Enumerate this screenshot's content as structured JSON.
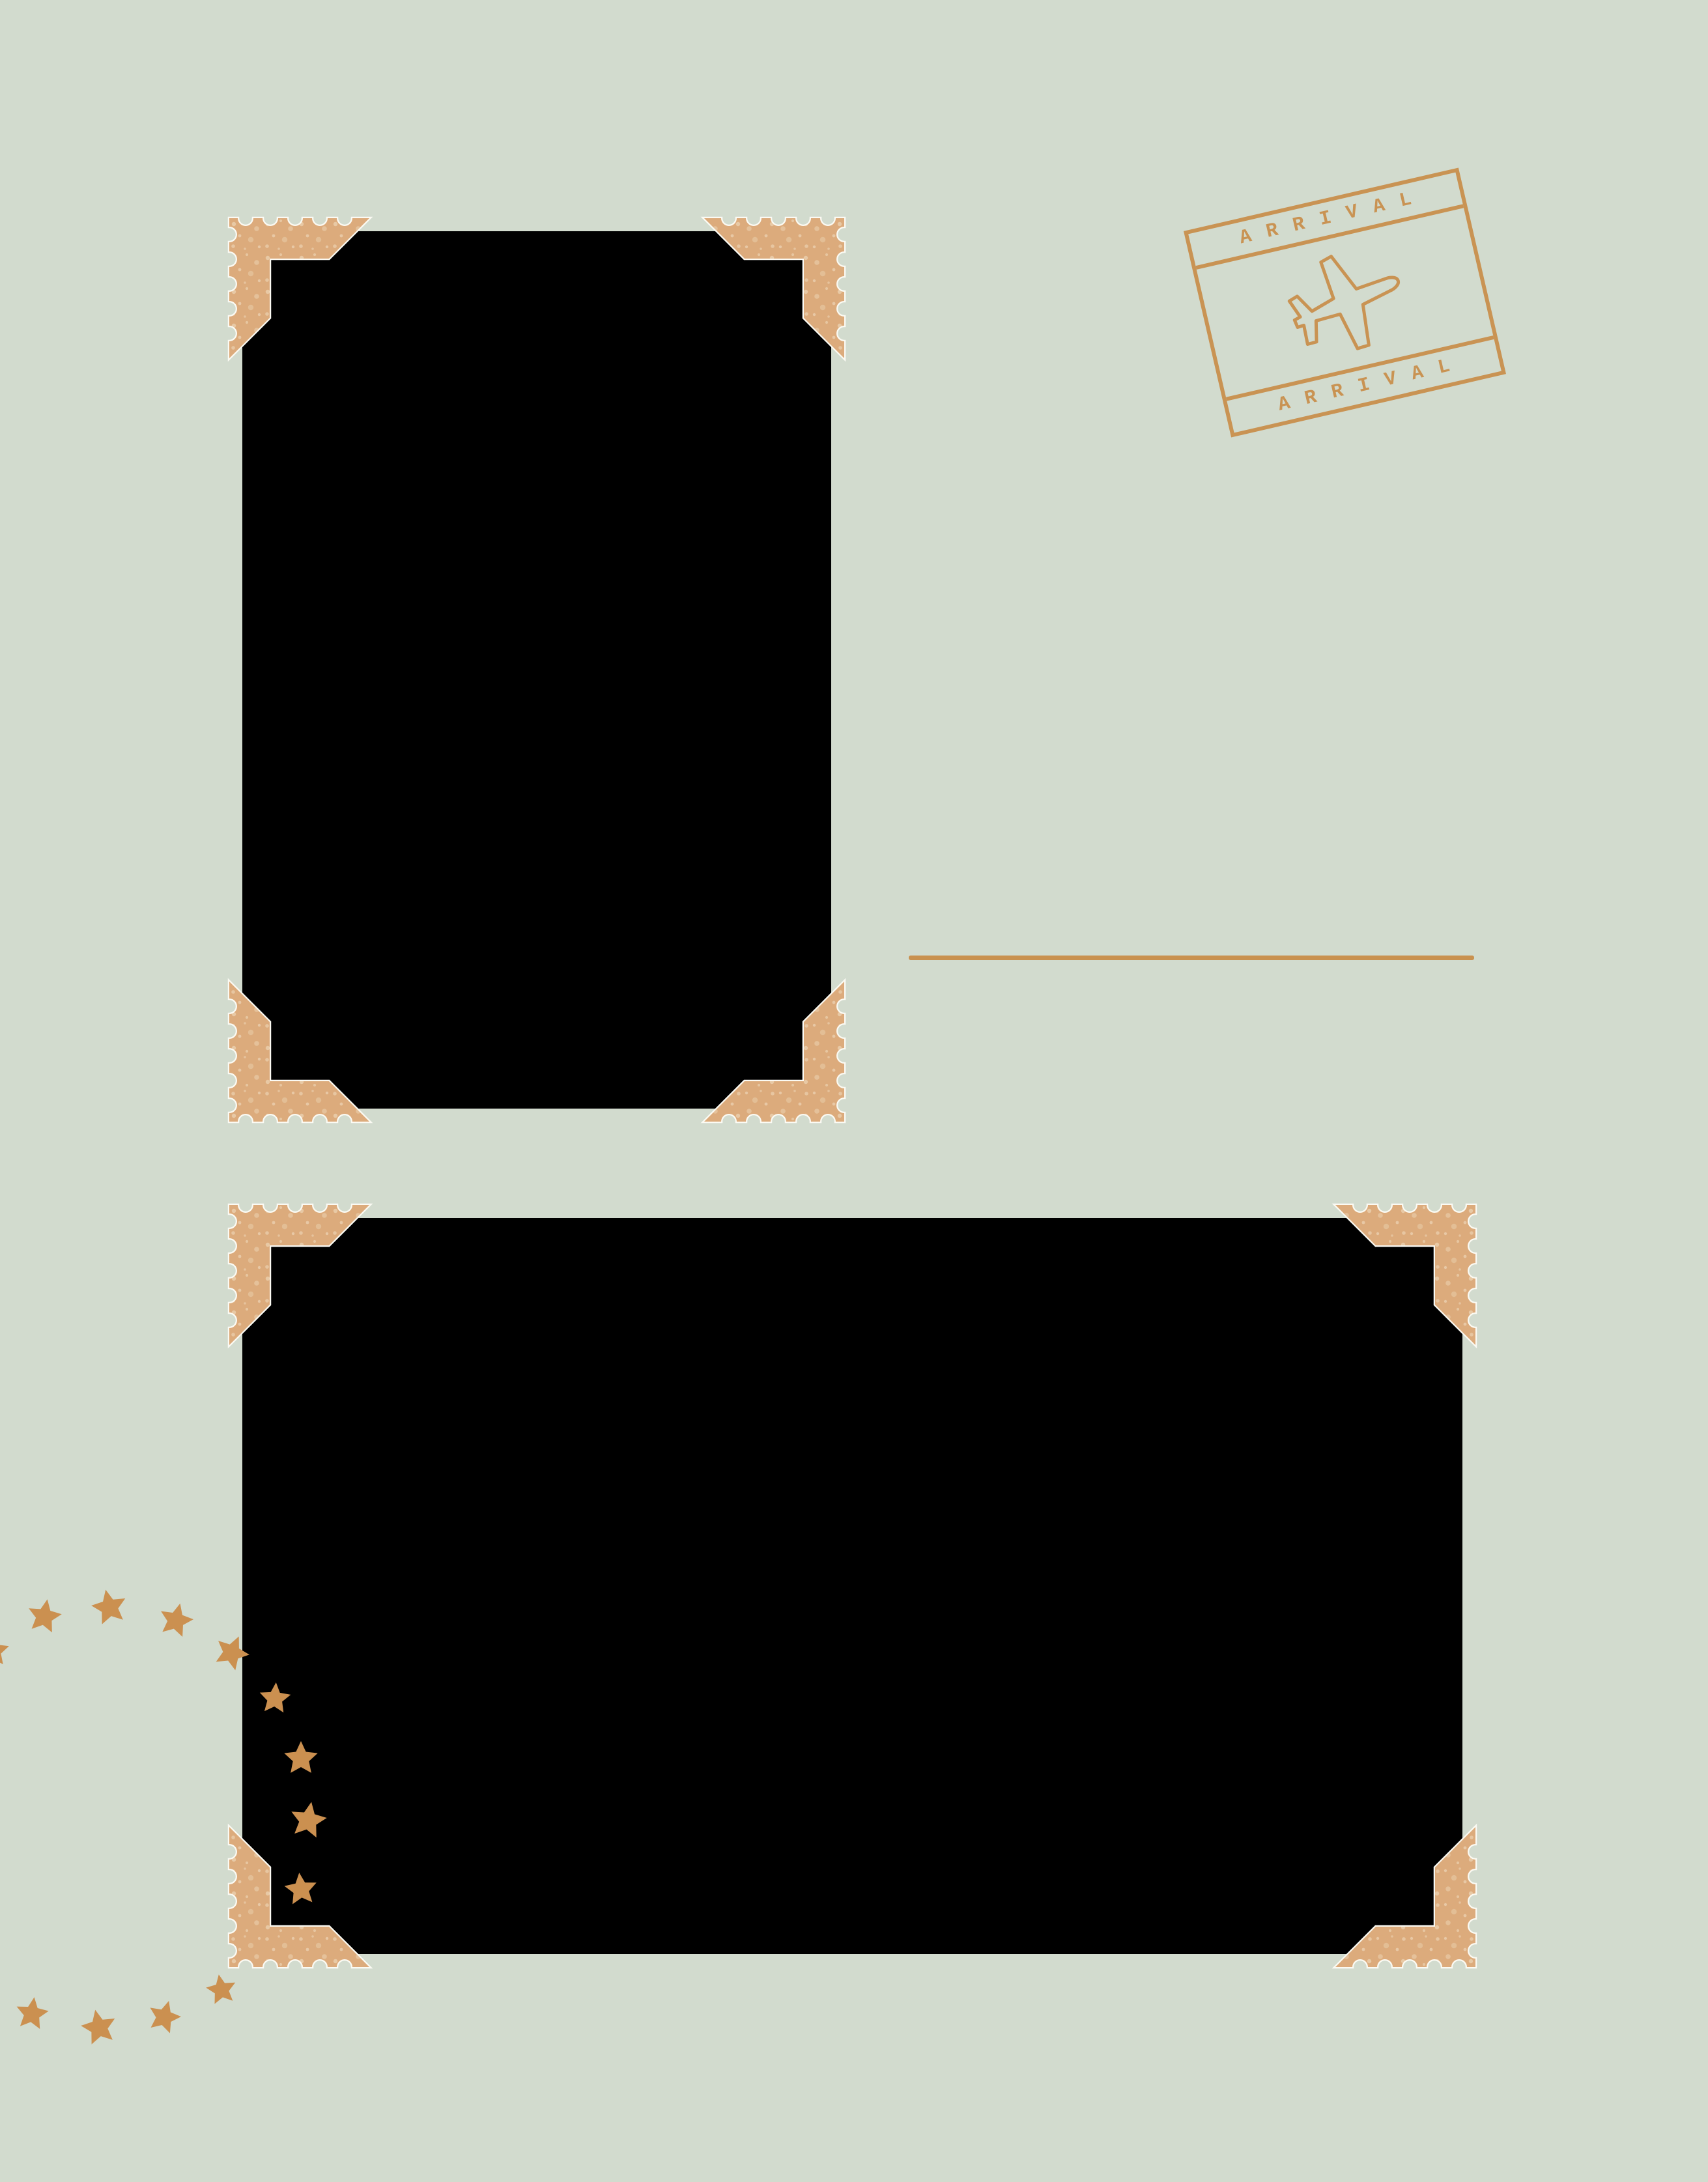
{
  "page": {
    "type": "travel-scrapbook-template",
    "background_color": "#d2dbce"
  },
  "colors": {
    "bg": "#d2dbce",
    "accent": "#c9914f",
    "star": "#cb9050",
    "mount": "#dcab7c",
    "photo": "#000000",
    "shadow": "#fbfaf3"
  },
  "stamp": {
    "top_label": "ARRIVAL",
    "bottom_label": "ARRIVAL",
    "icon": "airplane-icon"
  },
  "photos": [
    {
      "name": "photo-placeholder-1",
      "orientation": "portrait"
    },
    {
      "name": "photo-placeholder-2",
      "orientation": "landscape"
    }
  ],
  "decorations": {
    "corner_mount_icon": "stamp-corner-icon",
    "star_icon": "star-icon",
    "star_count": 13,
    "writing_line": true
  }
}
